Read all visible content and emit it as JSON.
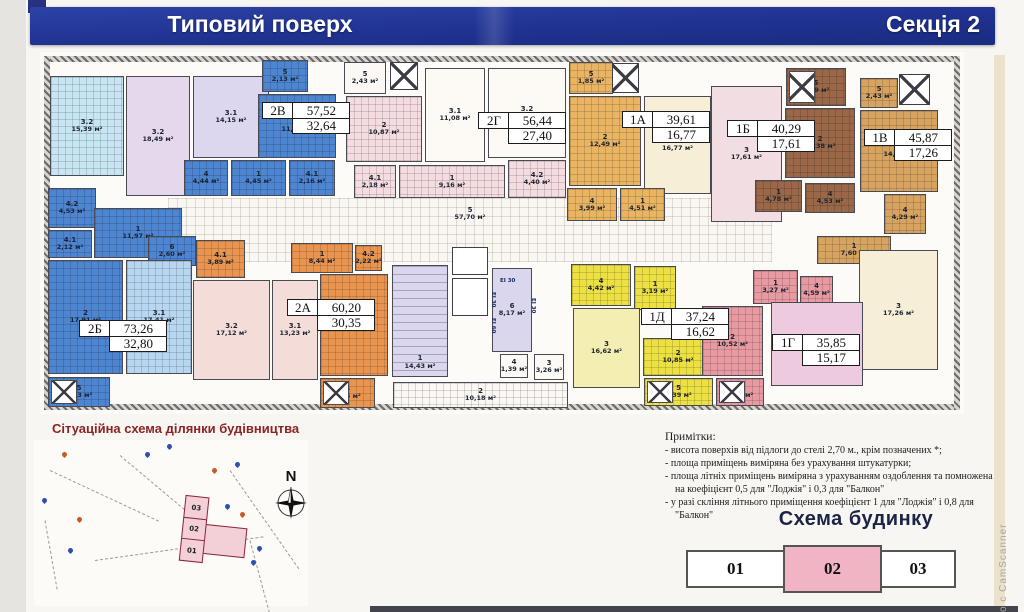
{
  "header": {
    "title": "Типовий поверх",
    "section": "Секція 2"
  },
  "watermark": "о с CamScanner",
  "plan": {
    "walls": [
      {
        "x": 44,
        "y": 56,
        "w": 916,
        "h": 6
      },
      {
        "x": 44,
        "y": 56,
        "w": 6,
        "h": 354
      },
      {
        "x": 44,
        "y": 404,
        "w": 916,
        "h": 6
      },
      {
        "x": 954,
        "y": 56,
        "w": 6,
        "h": 354
      }
    ],
    "rooms": [
      {
        "n": "5",
        "a": "57,70 м²",
        "x": 168,
        "y": 198,
        "w": 604,
        "h": 64,
        "bg": "#faf7f2",
        "cls": "cor"
      },
      {
        "n": "2",
        "a": "10,18 м²",
        "x": 393,
        "y": 382,
        "w": 175,
        "h": 26,
        "bg": "#fbf8f4",
        "g": 1
      },
      {
        "n": "3.2",
        "a": "15,39 м²",
        "x": 50,
        "y": 76,
        "w": 74,
        "h": 100,
        "bg": "#c7e5f2",
        "g": 1
      },
      {
        "n": "3.2",
        "a": "18,49 м²",
        "x": 126,
        "y": 76,
        "w": 64,
        "h": 120,
        "bg": "#e6d8ec"
      },
      {
        "n": "3.1",
        "a": "14,15 м²",
        "x": 193,
        "y": 76,
        "w": 76,
        "h": 82,
        "bg": "#dcd7ee"
      },
      {
        "n": "4",
        "a": "4,44 м²",
        "x": 184,
        "y": 160,
        "w": 44,
        "h": 36,
        "bg": "#4d85d1",
        "g": 1
      },
      {
        "n": "1",
        "a": "4,45 м²",
        "x": 231,
        "y": 160,
        "w": 55,
        "h": 36,
        "bg": "#4d85d1",
        "g": 1
      },
      {
        "n": "4.1",
        "a": "2,16 м²",
        "x": 289,
        "y": 160,
        "w": 46,
        "h": 36,
        "bg": "#4d85d1",
        "g": 1
      },
      {
        "n": "5",
        "a": "2,13 м²",
        "x": 262,
        "y": 60,
        "w": 46,
        "h": 32,
        "bg": "#4d85d1",
        "g": 1
      },
      {
        "n": "2",
        "a": "11,42 м²",
        "x": 258,
        "y": 94,
        "w": 78,
        "h": 64,
        "bg": "#4d85d1",
        "g": 1
      },
      {
        "n": "4.2",
        "a": "4,53 м²",
        "x": 48,
        "y": 188,
        "w": 48,
        "h": 40,
        "bg": "#4d85d1",
        "g": 1
      },
      {
        "n": "4.1",
        "a": "2,12 м²",
        "x": 48,
        "y": 230,
        "w": 44,
        "h": 28,
        "bg": "#4d85d1",
        "g": 1
      },
      {
        "n": "1",
        "a": "11,97 м²",
        "x": 94,
        "y": 208,
        "w": 88,
        "h": 50,
        "bg": "#4d85d1",
        "g": 1
      },
      {
        "n": "6",
        "a": "2,60 м²",
        "x": 148,
        "y": 236,
        "w": 48,
        "h": 30,
        "bg": "#4d85d1",
        "g": 1
      },
      {
        "n": "2",
        "a": "17,91 м²",
        "x": 48,
        "y": 260,
        "w": 75,
        "h": 114,
        "bg": "#4d85d1",
        "g": 1
      },
      {
        "n": "3.1",
        "a": "17,41 м²",
        "x": 126,
        "y": 260,
        "w": 66,
        "h": 114,
        "bg": "#b7d6f0",
        "g": 1
      },
      {
        "n": "5",
        "a": "2,23 м²",
        "x": 48,
        "y": 377,
        "w": 62,
        "h": 30,
        "bg": "#4d85d1",
        "g": 1,
        "xm": 1
      },
      {
        "n": "5",
        "a": "2,43 м²",
        "x": 344,
        "y": 62,
        "w": 42,
        "h": 32,
        "bg": "#fcf8f5"
      },
      {
        "n": "2",
        "a": "10,87 м²",
        "x": 346,
        "y": 96,
        "w": 76,
        "h": 66,
        "bg": "#f4dce0",
        "g": 1
      },
      {
        "n": "3.1",
        "a": "11,08 м²",
        "x": 425,
        "y": 68,
        "w": 60,
        "h": 94,
        "bg": "#fdf9f5"
      },
      {
        "n": "3.2",
        "a": "16,32 м²",
        "x": 488,
        "y": 68,
        "w": 78,
        "h": 90,
        "bg": "#fdf9f5"
      },
      {
        "n": "4.1",
        "a": "2,18 м²",
        "x": 354,
        "y": 165,
        "w": 42,
        "h": 33,
        "bg": "#f4dce0",
        "g": 1
      },
      {
        "n": "1",
        "a": "9,16 м²",
        "x": 399,
        "y": 165,
        "w": 106,
        "h": 33,
        "bg": "#f4dce0",
        "g": 1
      },
      {
        "n": "4.2",
        "a": "4,40 м²",
        "x": 508,
        "y": 160,
        "w": 58,
        "h": 38,
        "bg": "#f4dce0",
        "g": 1
      },
      {
        "n": "5",
        "a": "1,85 м²",
        "x": 569,
        "y": 62,
        "w": 44,
        "h": 32,
        "bg": "#e9b563",
        "g": 1
      },
      {
        "n": "2",
        "a": "12,49 м²",
        "x": 569,
        "y": 96,
        "w": 72,
        "h": 90,
        "bg": "#e9b563",
        "g": 1
      },
      {
        "n": "3",
        "a": "16,77 м²",
        "x": 644,
        "y": 96,
        "w": 67,
        "h": 98,
        "bg": "#f6eed6"
      },
      {
        "n": "4",
        "a": "3,99 м²",
        "x": 567,
        "y": 188,
        "w": 50,
        "h": 33,
        "bg": "#e9b563",
        "g": 1
      },
      {
        "n": "1",
        "a": "4,51 м²",
        "x": 620,
        "y": 188,
        "w": 45,
        "h": 33,
        "bg": "#e9b563",
        "g": 1
      },
      {
        "n": "3",
        "a": "17,61 м²",
        "x": 711,
        "y": 86,
        "w": 71,
        "h": 136,
        "bg": "#f2dee2"
      },
      {
        "n": "5",
        "a": "2,29 м²",
        "x": 786,
        "y": 68,
        "w": 60,
        "h": 38,
        "bg": "#9a6848",
        "g": 1,
        "xm": 1
      },
      {
        "n": "2",
        "a": "11,38 м²",
        "x": 785,
        "y": 108,
        "w": 70,
        "h": 70,
        "bg": "#9a6848",
        "g": 1
      },
      {
        "n": "1",
        "a": "4,78 м²",
        "x": 755,
        "y": 180,
        "w": 47,
        "h": 32,
        "bg": "#9a6848",
        "g": 1
      },
      {
        "n": "4",
        "a": "4,53 м²",
        "x": 805,
        "y": 183,
        "w": 50,
        "h": 30,
        "bg": "#9a6848",
        "g": 1
      },
      {
        "n": "5",
        "a": "2,43 м²",
        "x": 860,
        "y": 78,
        "w": 38,
        "h": 30,
        "bg": "#d6a360",
        "g": 1
      },
      {
        "n": "2",
        "a": "14,29 м²",
        "x": 860,
        "y": 110,
        "w": 78,
        "h": 82,
        "bg": "#d6a360",
        "g": 1
      },
      {
        "n": "4",
        "a": "4,29 м²",
        "x": 884,
        "y": 194,
        "w": 42,
        "h": 40,
        "bg": "#d6a360",
        "g": 1
      },
      {
        "n": "1",
        "a": "7,60 м²",
        "x": 817,
        "y": 236,
        "w": 74,
        "h": 28,
        "bg": "#d6a360",
        "g": 1
      },
      {
        "n": "3",
        "a": "17,26 м²",
        "x": 859,
        "y": 250,
        "w": 79,
        "h": 120,
        "bg": "#f6eed6"
      },
      {
        "n": "4.1",
        "a": "3,89 м²",
        "x": 196,
        "y": 240,
        "w": 49,
        "h": 38,
        "bg": "#e9954f",
        "g": 1
      },
      {
        "n": "1",
        "a": "8,44 м²",
        "x": 291,
        "y": 243,
        "w": 62,
        "h": 30,
        "bg": "#e9954f",
        "g": 1
      },
      {
        "n": "4.2",
        "a": "2,22 м²",
        "x": 355,
        "y": 245,
        "w": 27,
        "h": 26,
        "bg": "#e9954f",
        "g": 1
      },
      {
        "n": "3.2",
        "a": "17,12 м²",
        "x": 193,
        "y": 280,
        "w": 77,
        "h": 100,
        "bg": "#f4dcd8"
      },
      {
        "n": "3.1",
        "a": "13,23 м²",
        "x": 272,
        "y": 280,
        "w": 46,
        "h": 100,
        "bg": "#f4dcd8"
      },
      {
        "n": "2",
        "a": "13,16 м²",
        "x": 320,
        "y": 274,
        "w": 68,
        "h": 102,
        "bg": "#e9954f",
        "g": 1
      },
      {
        "n": "5",
        "a": "2,14 м²",
        "x": 320,
        "y": 378,
        "w": 55,
        "h": 30,
        "bg": "#e9954f",
        "g": 1,
        "xm": 1
      },
      {
        "n": "1",
        "a": "14,43 м²",
        "x": 392,
        "y": 265,
        "w": 56,
        "h": 112,
        "bg": "#dad6ed",
        "st": 1
      },
      {
        "n": "6",
        "a": "8,17 м²",
        "x": 492,
        "y": 268,
        "w": 40,
        "h": 84,
        "bg": "#dad6ed"
      },
      {
        "n": "4",
        "a": "1,39 м²",
        "x": 500,
        "y": 354,
        "w": 28,
        "h": 24,
        "bg": "#fdf9f5"
      },
      {
        "n": "3",
        "a": "3,26 м²",
        "x": 534,
        "y": 354,
        "w": 30,
        "h": 26,
        "bg": "#fdf9f5"
      },
      {
        "n": "4",
        "a": "4,42 м²",
        "x": 571,
        "y": 264,
        "w": 60,
        "h": 42,
        "bg": "#ece043",
        "g": 1
      },
      {
        "n": "1",
        "a": "3,19 м²",
        "x": 634,
        "y": 266,
        "w": 42,
        "h": 44,
        "bg": "#ece043",
        "g": 1
      },
      {
        "n": "3",
        "a": "16,62 м²",
        "x": 573,
        "y": 308,
        "w": 67,
        "h": 80,
        "bg": "#f4eeb2"
      },
      {
        "n": "2",
        "a": "10,85 м²",
        "x": 643,
        "y": 338,
        "w": 70,
        "h": 38,
        "bg": "#ece043",
        "g": 1
      },
      {
        "n": "5",
        "a": "2,39 м²",
        "x": 644,
        "y": 378,
        "w": 69,
        "h": 28,
        "bg": "#ece043",
        "g": 1,
        "xm": 1
      },
      {
        "n": "1",
        "a": "3,27 м²",
        "x": 753,
        "y": 270,
        "w": 45,
        "h": 34,
        "bg": "#e89aa2",
        "g": 1
      },
      {
        "n": "4",
        "a": "4,59 м²",
        "x": 800,
        "y": 276,
        "w": 33,
        "h": 28,
        "bg": "#e89aa2",
        "g": 1
      },
      {
        "n": "2",
        "a": "10,52 м²",
        "x": 702,
        "y": 306,
        "w": 61,
        "h": 70,
        "bg": "#e89aa2",
        "g": 1
      },
      {
        "n": "5",
        "a": "2,28 м²",
        "x": 716,
        "y": 378,
        "w": 48,
        "h": 28,
        "bg": "#e89aa2",
        "g": 1,
        "xm": 1
      },
      {
        "n": "3",
        "a": "15,17 м²",
        "x": 771,
        "y": 302,
        "w": 92,
        "h": 84,
        "bg": "#eecade"
      }
    ],
    "apartments": [
      {
        "code": "2В",
        "total": "57,52",
        "living": "32,64",
        "x": 262,
        "y": 102
      },
      {
        "code": "2Г",
        "total": "56,44",
        "living": "27,40",
        "x": 478,
        "y": 112
      },
      {
        "code": "1А",
        "total": "39,61",
        "living": "16,77",
        "x": 622,
        "y": 111
      },
      {
        "code": "1Б",
        "total": "40,29",
        "living": "17,61",
        "x": 727,
        "y": 120
      },
      {
        "code": "1В",
        "total": "45,87",
        "living": "17,26",
        "x": 864,
        "y": 129
      },
      {
        "code": "2Б",
        "total": "73,26",
        "living": "32,80",
        "x": 79,
        "y": 320
      },
      {
        "code": "2А",
        "total": "60,20",
        "living": "30,35",
        "x": 287,
        "y": 299
      },
      {
        "code": "1Д",
        "total": "37,24",
        "living": "16,62",
        "x": 641,
        "y": 308
      },
      {
        "code": "1Г",
        "total": "35,85",
        "living": "15,17",
        "x": 772,
        "y": 334
      }
    ],
    "shafts": [
      {
        "x": 390,
        "y": 62,
        "w": 28,
        "h": 28,
        "xm": 1
      },
      {
        "x": 612,
        "y": 63,
        "w": 27,
        "h": 30,
        "xm": 1
      },
      {
        "x": 899,
        "y": 74,
        "w": 31,
        "h": 31,
        "xm": 1
      },
      {
        "x": 452,
        "y": 247,
        "w": 36,
        "h": 28
      },
      {
        "x": 452,
        "y": 278,
        "w": 36,
        "h": 38
      }
    ],
    "fire_labels": [
      {
        "t": "ЕІ 30",
        "x": 500,
        "y": 278
      },
      {
        "t": "ЕІ 30",
        "x": 490,
        "y": 292,
        "v": 1
      },
      {
        "t": "ЕІ 60",
        "x": 490,
        "y": 318,
        "v": 1
      },
      {
        "t": "ЕІ 30",
        "x": 530,
        "y": 298,
        "v": 1
      }
    ]
  },
  "site_plan": {
    "title": "Сітуаційна схема ділянки будівництва",
    "compass": "N",
    "building_blocks": [
      "03",
      "02",
      "01"
    ],
    "pins": [
      {
        "x": 28,
        "y": 12,
        "c": "#c75b28"
      },
      {
        "x": 133,
        "y": 4,
        "c": "#2d4fae"
      },
      {
        "x": 201,
        "y": 22,
        "c": "#2d4fae"
      },
      {
        "x": 178,
        "y": 28,
        "c": "#c75b28"
      },
      {
        "x": 206,
        "y": 72,
        "c": "#c75b28"
      },
      {
        "x": 191,
        "y": 64,
        "c": "#2d4fae"
      },
      {
        "x": 223,
        "y": 106,
        "c": "#2d4fae"
      },
      {
        "x": 217,
        "y": 120,
        "c": "#2d4fae"
      },
      {
        "x": 34,
        "y": 108,
        "c": "#2d4fae"
      },
      {
        "x": 43,
        "y": 77,
        "c": "#c75b28"
      },
      {
        "x": 8,
        "y": 58,
        "c": "#2d4fae"
      },
      {
        "x": 111,
        "y": 12,
        "c": "#2d4fae"
      }
    ],
    "lines": [
      {
        "x": 16,
        "y": 30,
        "w": 120,
        "r": 25
      },
      {
        "x": 61,
        "y": 120,
        "w": 170,
        "r": -8
      },
      {
        "x": 86,
        "y": 15,
        "w": 130,
        "r": 40
      },
      {
        "x": 196,
        "y": 30,
        "w": 120,
        "r": 55
      },
      {
        "x": 11,
        "y": 80,
        "w": 70,
        "r": 80
      },
      {
        "x": 216,
        "y": 100,
        "w": 90,
        "r": 75
      }
    ]
  },
  "notes": {
    "title": "Примітки:",
    "items": [
      "- висота поверхів від підлоги до стелі 2,70 м., крім позначених *;",
      "- площа приміщень виміряна без урахування штукатурки;",
      "- площа літніх приміщень виміряна з урахуванням оздоблення та помножена на коефіцієнт 0,5 для \"Лоджія\" і 0,3 для \"Балкон\"",
      "- у разі скління літнього приміщення коефіцієнт 1 для \"Лоджія\" і 0,8 для \"Балкон\""
    ]
  },
  "building_scheme": {
    "title": "Схема будинку",
    "blocks": [
      {
        "label": "01",
        "w": 99,
        "highlighted": false
      },
      {
        "label": "02",
        "w": 99,
        "highlighted": true
      },
      {
        "label": "03",
        "w": 76,
        "highlighted": false
      }
    ]
  }
}
